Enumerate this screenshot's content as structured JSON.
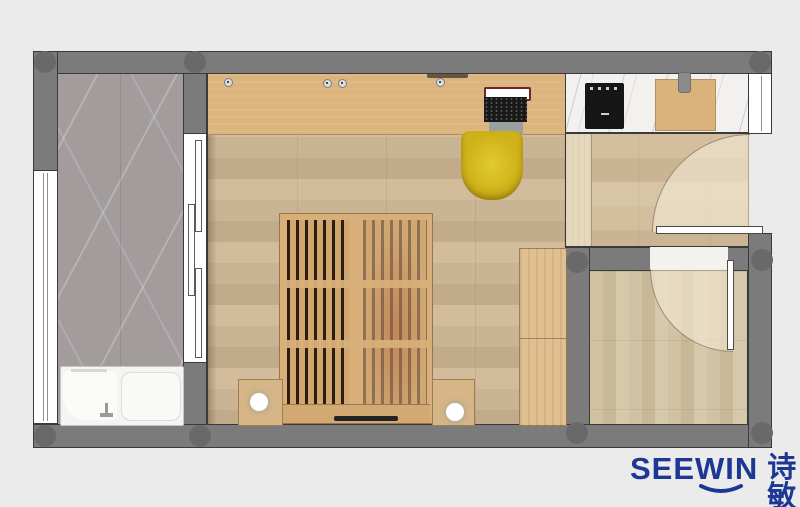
{
  "logo": {
    "brand_latin": "SEEWIN",
    "brand_cn": "诗敏"
  },
  "colors": {
    "bg": "#ecebeb",
    "wall": "#7b7b7b",
    "wall_dark": "#696969",
    "outline": "#3a3a3a",
    "floor_main": "#c9b494",
    "floor_main_alt": "#c1ab8b",
    "floor_main_light": "#d2bc9c",
    "floor_entry": "#d0bc9b",
    "floor_room2": "#cfc0a2",
    "threshold": "#e6d8bd",
    "desk_wood": "#dcb57e",
    "bed_frame": "#d8af79",
    "bed_gap_dark": "#2c1d0f",
    "bed_gap_light": "#8d7055",
    "wardrobe": "#e0c090",
    "marble_floor": "#a29c9d",
    "counter": "#f3f1ef",
    "chair_yellow": "#cfb11a",
    "chair_yellow_light": "#e2ca30",
    "white_fixture": "#f4f4f2",
    "swing": "rgba(243,233,212,0.62)",
    "stove": "#161616",
    "logo_blue": "#1c3894"
  },
  "objects": [
    "shower-bathroom",
    "left-window",
    "bathtub",
    "sliding-door",
    "main-room",
    "wall-desk",
    "laptop",
    "desk-chair",
    "platform-slat-bed",
    "nightstand-left",
    "nightstand-right",
    "table-lamp",
    "wardrobe",
    "kitchen-counter",
    "cooktop",
    "cutting-board",
    "top-right-window",
    "entry-hall",
    "entry-door",
    "entry-door-swing",
    "second-room",
    "interior-door",
    "interior-door-swing",
    "structural-columns"
  ]
}
